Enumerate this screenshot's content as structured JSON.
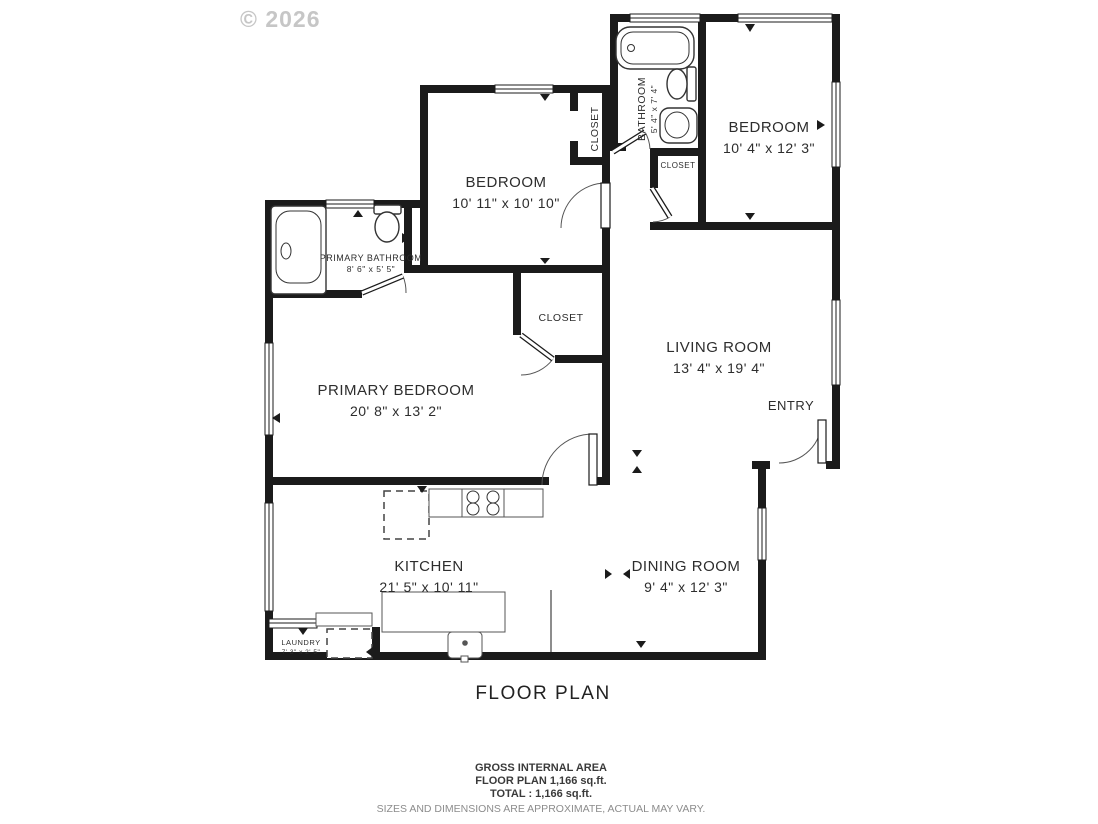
{
  "watermark": "© 2026",
  "plan": {
    "title": "FLOOR PLAN",
    "rooms": {
      "bathroom": {
        "name": "BATHROOM",
        "dims": "5' 4\" x 7' 4\""
      },
      "bedroom_top_right": {
        "name": "BEDROOM",
        "dims": "10' 4\" x 12' 3\""
      },
      "bedroom_middle": {
        "name": "BEDROOM",
        "dims": "10' 11\" x 10' 10\""
      },
      "primary_bathroom": {
        "name": "PRIMARY BATHROOM",
        "dims": "8' 6\" x 5' 5\""
      },
      "primary_bedroom": {
        "name": "PRIMARY BEDROOM",
        "dims": "20' 8\" x 13' 2\""
      },
      "living_room": {
        "name": "LIVING ROOM",
        "dims": "13' 4\" x 19' 4\""
      },
      "kitchen": {
        "name": "KITCHEN",
        "dims": "21' 5\" x 10' 11\""
      },
      "dining_room": {
        "name": "DINING ROOM",
        "dims": "9' 4\" x 12' 3\""
      },
      "laundry": {
        "name": "LAUNDRY",
        "dims": "7' 3\" x 2' 5\""
      },
      "entry": {
        "name": "ENTRY"
      },
      "closet_bedroom": {
        "name": "CLOSET"
      },
      "closet_hall": {
        "name": "CLOSET"
      },
      "closet_primary": {
        "name": "CLOSET"
      }
    }
  },
  "footer": {
    "line1": "GROSS INTERNAL AREA",
    "line2": "FLOOR PLAN 1,166 sq.ft.",
    "line3": "TOTAL :  1,166 sq.ft.",
    "disclaimer": "SIZES AND DIMENSIONS ARE APPROXIMATE, ACTUAL MAY VARY."
  },
  "colors": {
    "wall": "#1b1b1b",
    "label_text": "#2d2d2d",
    "watermark": "#c6c6c6",
    "disclaimer_text": "#8c8c8c",
    "background": "#ffffff"
  }
}
